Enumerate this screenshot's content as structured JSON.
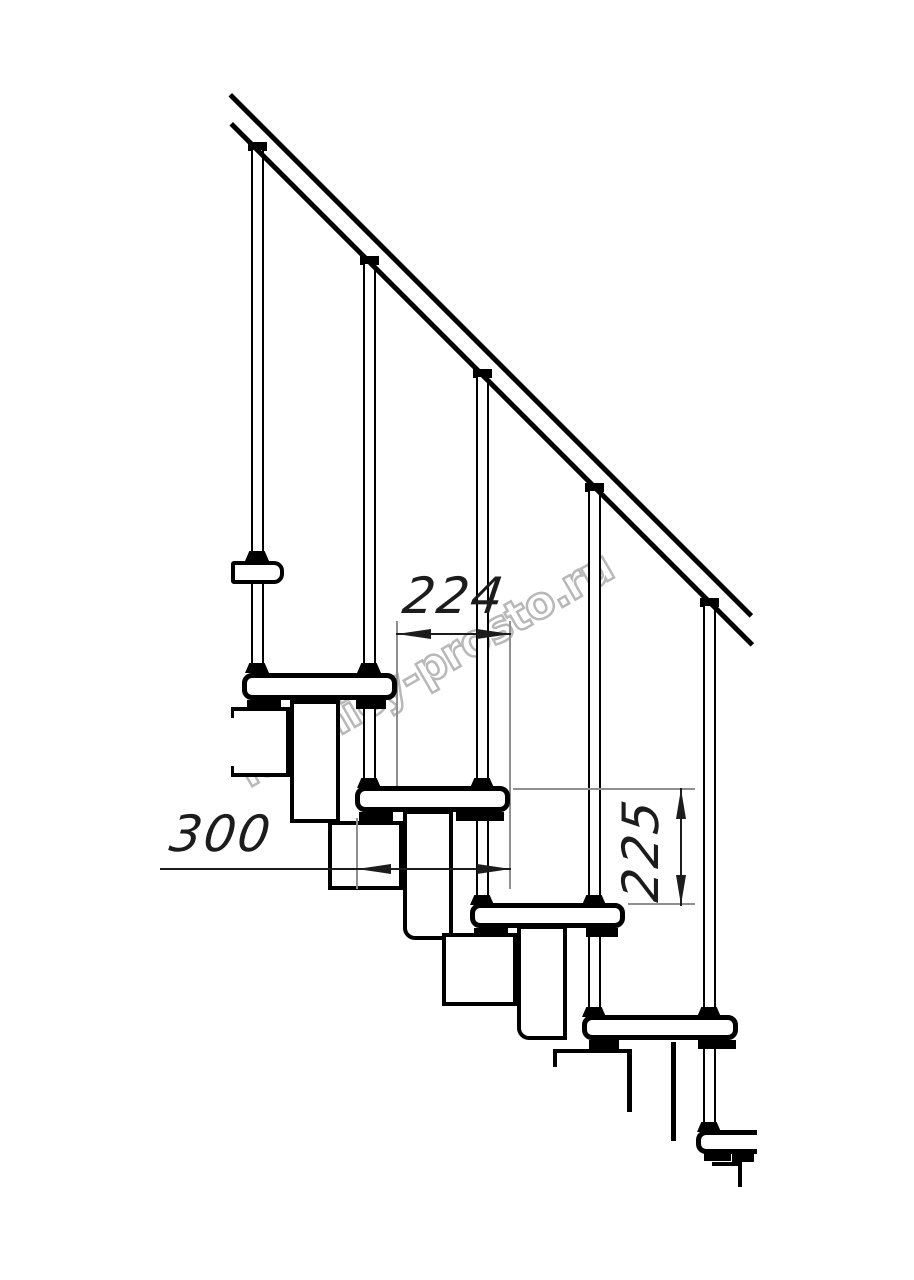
{
  "watermark": {
    "text": "lestnicy-prosto.ru",
    "color": "#b8b8b8"
  },
  "dimensions": {
    "going": {
      "value": "224",
      "orientation": "horizontal"
    },
    "depth": {
      "value": "300",
      "orientation": "horizontal"
    },
    "rise": {
      "value": "225",
      "orientation": "vertical"
    }
  },
  "colors": {
    "ink": "#000000",
    "dim": "#1c1c1c",
    "ext": "#8f8f8f",
    "wm": "#b8b8b8",
    "bg": "#ffffff"
  }
}
